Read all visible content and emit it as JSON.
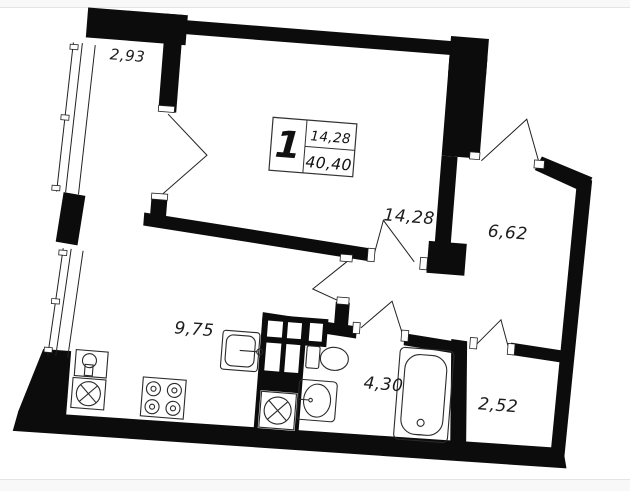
{
  "page": {
    "canvas_color": "#ffffff",
    "band_fill": "#f8f8f8",
    "band_line": "#e4e4e4",
    "ink_color": "#0c0c0c"
  },
  "plan": {
    "badge": {
      "rooms_count": "1",
      "living_area": "14,28",
      "total_area": "40,40"
    },
    "rooms": [
      {
        "id": "balcony",
        "area": "2,93"
      },
      {
        "id": "living-room",
        "area": "14,28"
      },
      {
        "id": "hallway",
        "area": "6,62"
      },
      {
        "id": "kitchen",
        "area": "9,75"
      },
      {
        "id": "bathroom",
        "area": "4,30"
      },
      {
        "id": "storage",
        "area": "2,52"
      }
    ],
    "symbols": [
      "window-glazing",
      "door-swing",
      "ventilation-shaft-grid",
      "corner-sink-icon",
      "washing-machine-icon",
      "stove-icon",
      "kitchen-sink-icon",
      "toilet-icon",
      "washbasin-icon",
      "bathtub-icon"
    ]
  }
}
